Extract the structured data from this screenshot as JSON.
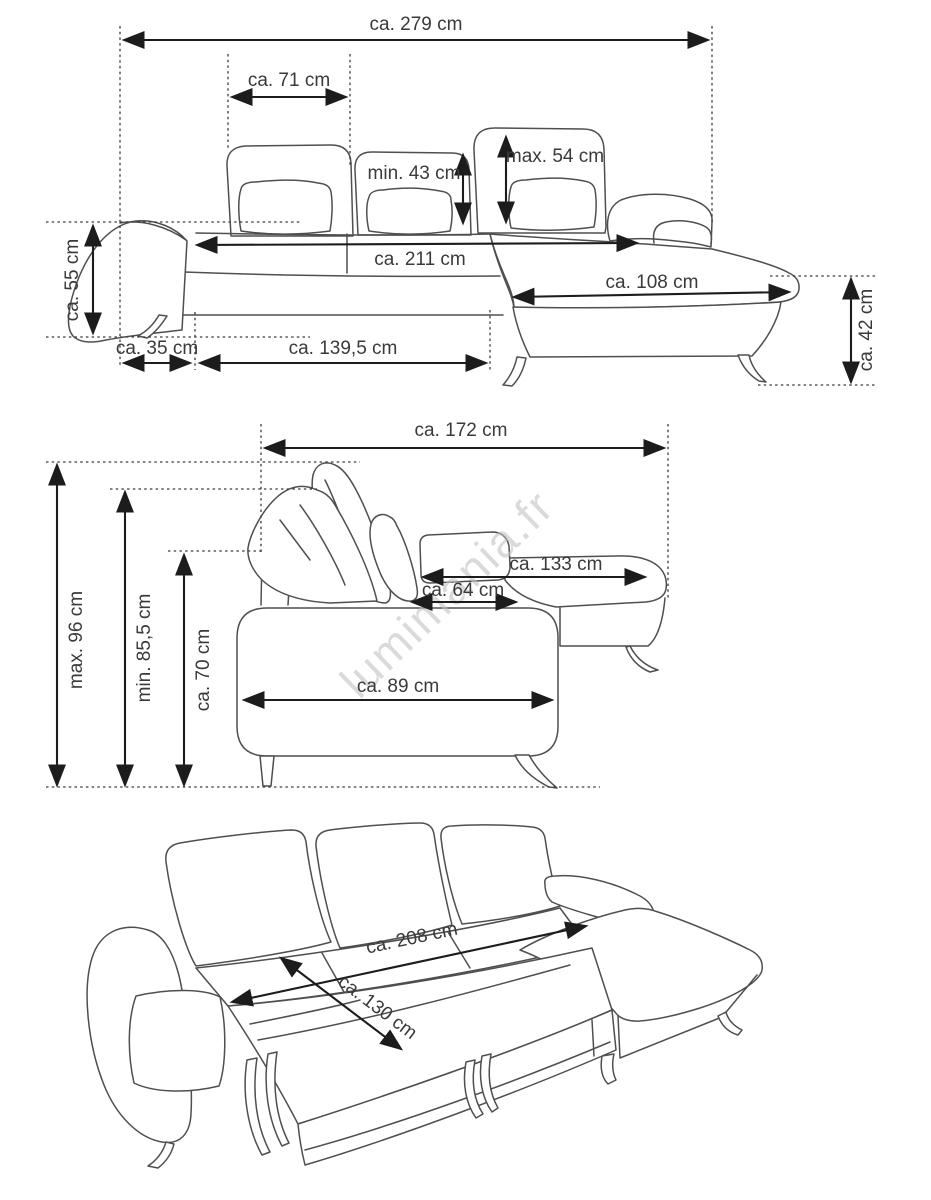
{
  "watermark": "lumimania.fr",
  "figures": {
    "front": {
      "total_width": "ca. 279 cm",
      "backrest_width": "ca. 71 cm",
      "headrest_height_min": "min. 43 cm",
      "headrest_height_max": "max. 54 cm",
      "armrest_height": "ca. 55 cm",
      "seat_width": "ca. 211 cm",
      "chaise_width": "ca. 108 cm",
      "seat_height": "ca. 42 cm",
      "armrest_width": "ca. 35 cm",
      "sleep_section_width": "ca. 139,5 cm"
    },
    "side": {
      "total_depth": "ca. 172 cm",
      "height_max": "max. 96 cm",
      "height_min": "min. 85,5 cm",
      "backrest_height": "ca. 70 cm",
      "chaise_depth": "ca. 133 cm",
      "seat_depth": "ca. 64 cm",
      "side_width": "ca. 89 cm"
    },
    "bed": {
      "bed_length": "ca. 208 cm",
      "bed_width": "ca. 130 cm"
    }
  },
  "colors": {
    "line": "#4f4f4f",
    "dimension": "#1c1c1c",
    "text": "#3a3a3a",
    "watermark": "#c2c2c2",
    "background": "#ffffff"
  }
}
